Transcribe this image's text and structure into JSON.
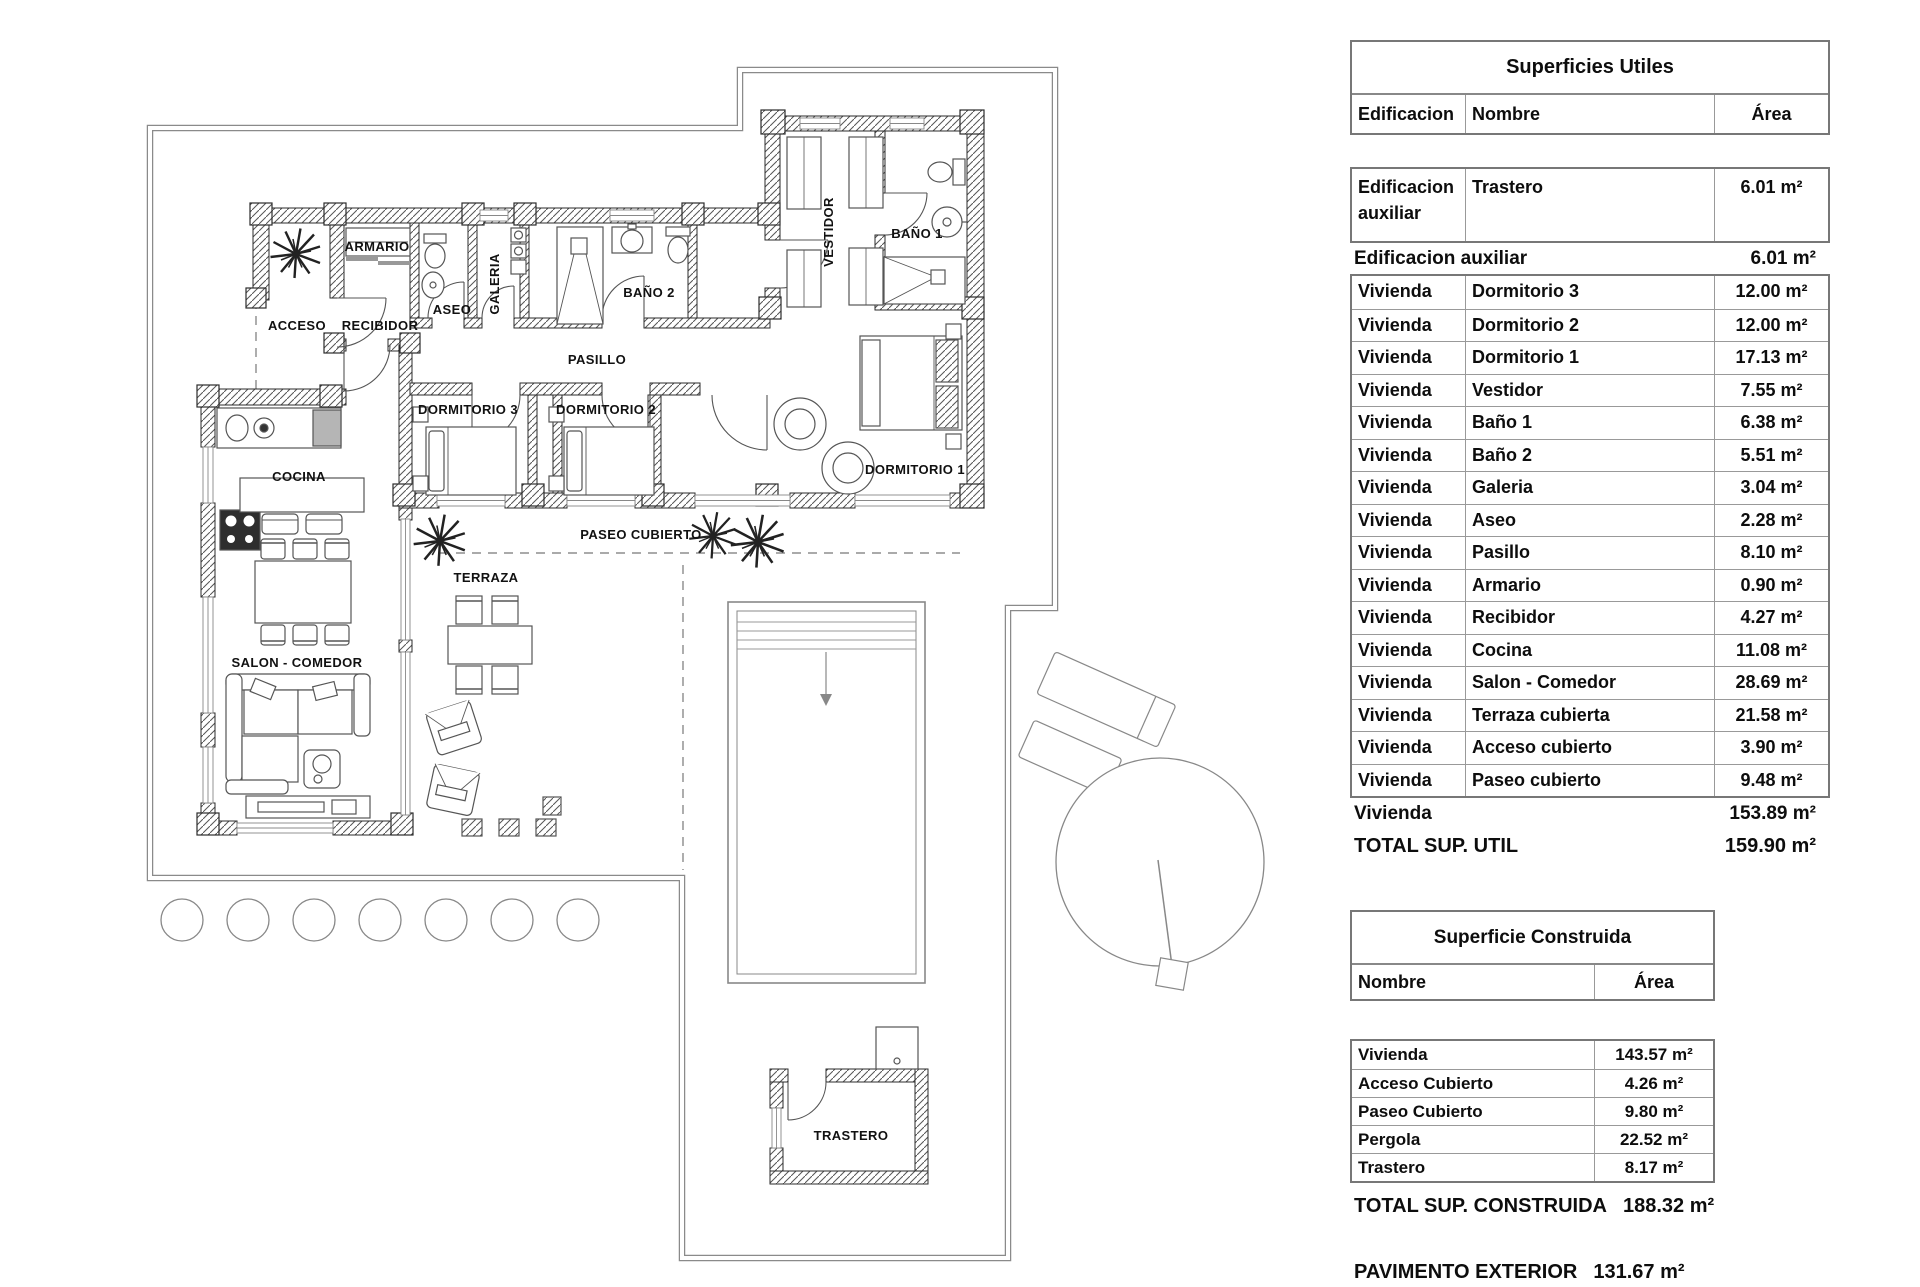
{
  "colors": {
    "wall_line": "#2b2b2b",
    "hatch": "#555",
    "thin_line": "#888",
    "text": "#111"
  },
  "plan": {
    "labels": [
      {
        "text": "ARMARIO",
        "x": 377,
        "y": 251,
        "size": 11
      },
      {
        "text": "ACCESO",
        "x": 297,
        "y": 330,
        "size": 12
      },
      {
        "text": "RECIBIDOR",
        "x": 380,
        "y": 330,
        "size": 11
      },
      {
        "text": "ASEO",
        "x": 452,
        "y": 314,
        "size": 12
      },
      {
        "text": "GALERIA",
        "x": 499,
        "y": 284,
        "size": 11,
        "rot": -90
      },
      {
        "text": "BAÑO 2",
        "x": 649,
        "y": 297,
        "size": 12
      },
      {
        "text": "PASILLO",
        "x": 597,
        "y": 364,
        "size": 13
      },
      {
        "text": "VESTIDOR",
        "x": 833,
        "y": 232,
        "size": 12,
        "rot": -90
      },
      {
        "text": "BAÑO 1",
        "x": 917,
        "y": 238,
        "size": 12
      },
      {
        "text": "DORMITORIO 3",
        "x": 468,
        "y": 414,
        "size": 12
      },
      {
        "text": "DORMITORIO 2",
        "x": 606,
        "y": 414,
        "size": 12
      },
      {
        "text": "DORMITORIO 1",
        "x": 915,
        "y": 474,
        "size": 12
      },
      {
        "text": "COCINA",
        "x": 299,
        "y": 481,
        "size": 12
      },
      {
        "text": "SALON - COMEDOR",
        "x": 297,
        "y": 667,
        "size": 12
      },
      {
        "text": "TERRAZA",
        "x": 486,
        "y": 582,
        "size": 12
      },
      {
        "text": "PASEO CUBIERTO",
        "x": 641,
        "y": 539,
        "size": 12
      },
      {
        "text": "TRASTERO",
        "x": 851,
        "y": 1140,
        "size": 12
      }
    ]
  },
  "tables": {
    "utiles": {
      "title": "Superficies Utiles",
      "headers": [
        "Edificacion",
        "Nombre",
        "Área"
      ],
      "first_row": {
        "edificacion": "Edificacion auxiliar",
        "nombre": "Trastero",
        "area": "6.01 m²"
      },
      "subtotal_aux": {
        "label": "Edificacion auxiliar",
        "value": "6.01 m²"
      },
      "rows": [
        [
          "Vivienda",
          "Dormitorio 3",
          "12.00 m²"
        ],
        [
          "Vivienda",
          "Dormitorio 2",
          "12.00 m²"
        ],
        [
          "Vivienda",
          "Dormitorio 1",
          "17.13 m²"
        ],
        [
          "Vivienda",
          "Vestidor",
          "7.55 m²"
        ],
        [
          "Vivienda",
          "Baño 1",
          "6.38 m²"
        ],
        [
          "Vivienda",
          "Baño 2",
          "5.51 m²"
        ],
        [
          "Vivienda",
          "Galeria",
          "3.04 m²"
        ],
        [
          "Vivienda",
          "Aseo",
          "2.28 m²"
        ],
        [
          "Vivienda",
          "Pasillo",
          "8.10 m²"
        ],
        [
          "Vivienda",
          "Armario",
          "0.90 m²"
        ],
        [
          "Vivienda",
          "Recibidor",
          "4.27 m²"
        ],
        [
          "Vivienda",
          "Cocina",
          "11.08 m²"
        ],
        [
          "Vivienda",
          "Salon - Comedor",
          "28.69 m²"
        ],
        [
          "Vivienda",
          "Terraza cubierta",
          "21.58 m²"
        ],
        [
          "Vivienda",
          "Acceso cubierto",
          "3.90 m²"
        ],
        [
          "Vivienda",
          "Paseo cubierto",
          "9.48 m²"
        ]
      ],
      "subtotal_viv": {
        "label": "Vivienda",
        "value": "153.89 m²"
      },
      "total": {
        "label": "TOTAL SUP. UTIL",
        "value": "159.90 m²"
      }
    },
    "construida": {
      "title": "Superficie Construida",
      "headers": [
        "Nombre",
        "Área"
      ],
      "rows": [
        [
          "Vivienda",
          "143.57 m²"
        ],
        [
          "Acceso Cubierto",
          "4.26 m²"
        ],
        [
          "Paseo Cubierto",
          "9.80 m²"
        ],
        [
          "Pergola",
          "22.52 m²"
        ],
        [
          "Trastero",
          "8.17 m²"
        ]
      ],
      "total": {
        "label": "TOTAL SUP. CONSTRUIDA",
        "value": "188.32 m²"
      },
      "pavimento": {
        "label": "PAVIMENTO EXTERIOR",
        "value": "131.67 m²"
      }
    }
  }
}
